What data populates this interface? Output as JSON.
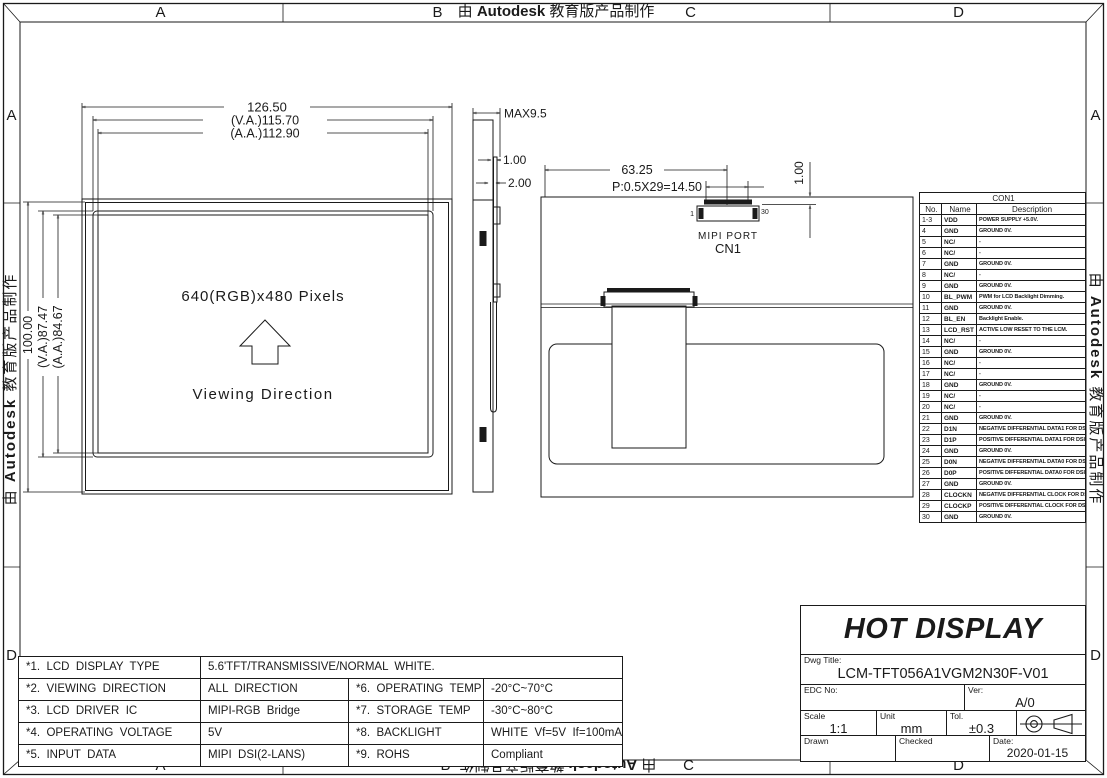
{
  "colors": {
    "line": "#1a1a1a",
    "background": "#ffffff"
  },
  "border": {
    "watermark": {
      "prefix": "由 ",
      "brand": "Autodesk",
      "suffix": " 教育版产品制作"
    },
    "zones": {
      "top": [
        "A",
        "B",
        "C",
        "D"
      ],
      "bottom": [
        "A",
        "B",
        "C",
        "D"
      ],
      "left": [
        "A",
        "D"
      ],
      "right": [
        "A",
        "D"
      ]
    }
  },
  "views": {
    "front": {
      "dim_width": "126.50",
      "dim_width_va": "(V.A.)115.70",
      "dim_width_aa": "(A.A.)112.90",
      "dim_height": "100.00",
      "dim_height_va": "(V.A.)87.47",
      "dim_height_aa": "(A.A.)84.67",
      "resolution": "640(RGB)x480  Pixels",
      "viewing_direction": "Viewing  Direction"
    },
    "side": {
      "dim_thickness": "MAX9.5",
      "dim_top_glass": "1.00",
      "dim_glass": "2.00"
    },
    "back": {
      "dim_connector_center": "63.25",
      "dim_pitch": "P:0.5X29=14.50",
      "dim_offset": "1.00",
      "pin_first": "1",
      "pin_last": "30",
      "port_label": "MIPI  PORT",
      "connector": "CN1"
    }
  },
  "pin_table": {
    "title": "CON1",
    "headers": [
      "No.",
      "Name",
      "Description"
    ],
    "rows": [
      [
        "1-3",
        "VDD",
        "POWER SUPPLY +5.0V."
      ],
      [
        "4",
        "GND",
        "GROUND 0V."
      ],
      [
        "5",
        "NC/",
        "-"
      ],
      [
        "6",
        "NC/",
        "-"
      ],
      [
        "7",
        "GND",
        "GROUND 0V."
      ],
      [
        "8",
        "NC/",
        "-"
      ],
      [
        "9",
        "GND",
        "GROUND 0V."
      ],
      [
        "10",
        "BL_PWM",
        "PWM for LCD Backlight Dimming."
      ],
      [
        "11",
        "GND",
        "GROUND 0V."
      ],
      [
        "12",
        "BL_EN",
        "Backlight Enable."
      ],
      [
        "13",
        "LCD_RST",
        "ACTIVE LOW RESET TO THE LCM."
      ],
      [
        "14",
        "NC/",
        "-"
      ],
      [
        "15",
        "GND",
        "GROUND 0V."
      ],
      [
        "16",
        "NC/",
        "-"
      ],
      [
        "17",
        "NC/",
        "-"
      ],
      [
        "18",
        "GND",
        "GROUND 0V."
      ],
      [
        "19",
        "NC/",
        "-"
      ],
      [
        "20",
        "NC/",
        "-"
      ],
      [
        "21",
        "GND",
        "GROUND 0V."
      ],
      [
        "22",
        "D1N",
        "NEGATIVE DIFFERENTIAL DATA1 FOR DSI."
      ],
      [
        "23",
        "D1P",
        "POSITIVE DIFFERENTIAL DATA1 FOR DSI."
      ],
      [
        "24",
        "GND",
        "GROUND 0V."
      ],
      [
        "25",
        "D0N",
        "NEGATIVE DIFFERENTIAL DATA0 FOR DSI."
      ],
      [
        "26",
        "D0P",
        "POSITIVE DIFFERENTIAL DATA0 FOR DSI."
      ],
      [
        "27",
        "GND",
        "GROUND 0V."
      ],
      [
        "28",
        "CLOCKN",
        "NEGATIVE DIFFERENTIAL CLOCK FOR DSI."
      ],
      [
        "29",
        "CLOCKP",
        "POSITIVE DIFFERENTIAL CLOCK FOR DSI."
      ],
      [
        "30",
        "GND",
        "GROUND 0V."
      ]
    ]
  },
  "spec_table": {
    "row1": {
      "label": "*1.  LCD  DISPLAY  TYPE",
      "value": "5.6'TFT/TRANSMISSIVE/NORMAL  WHITE."
    },
    "rows": [
      {
        "l1": "*2.  VIEWING  DIRECTION",
        "v1": "ALL  DIRECTION",
        "l2": "*6.  OPERATING  TEMP",
        "v2": "-20°C~70°C"
      },
      {
        "l1": "*3.  LCD  DRIVER  IC",
        "v1": "MIPI-RGB  Bridge",
        "l2": "*7.  STORAGE  TEMP",
        "v2": "-30°C~80°C"
      },
      {
        "l1": "*4.  OPERATING  VOLTAGE",
        "v1": "5V",
        "l2": "*8.  BACKLIGHT",
        "v2": "WHITE  Vf=5V  If=100mA"
      },
      {
        "l1": "*5.  INPUT  DATA",
        "v1": "MIPI  DSI(2-LANS)",
        "l2": "*9.  ROHS",
        "v2": "Compliant"
      }
    ]
  },
  "title_block": {
    "company": "HOT DISPLAY",
    "dwg_title_label": "Dwg  Title:",
    "dwg_title": "LCM-TFT056A1VGM2N30F-V01",
    "edc_label": "EDC  No:",
    "edc_value": "",
    "ver_label": "Ver:",
    "ver_value": "A/0",
    "scale_label": "Scale",
    "scale_value": "1:1",
    "unit_label": "Unit",
    "unit_value": "mm",
    "tol_label": "Tol.",
    "tol_value": "±0.3",
    "drawn_label": "Drawn",
    "checked_label": "Checked",
    "date_label": "Date:",
    "date_value": "2020-01-15"
  }
}
